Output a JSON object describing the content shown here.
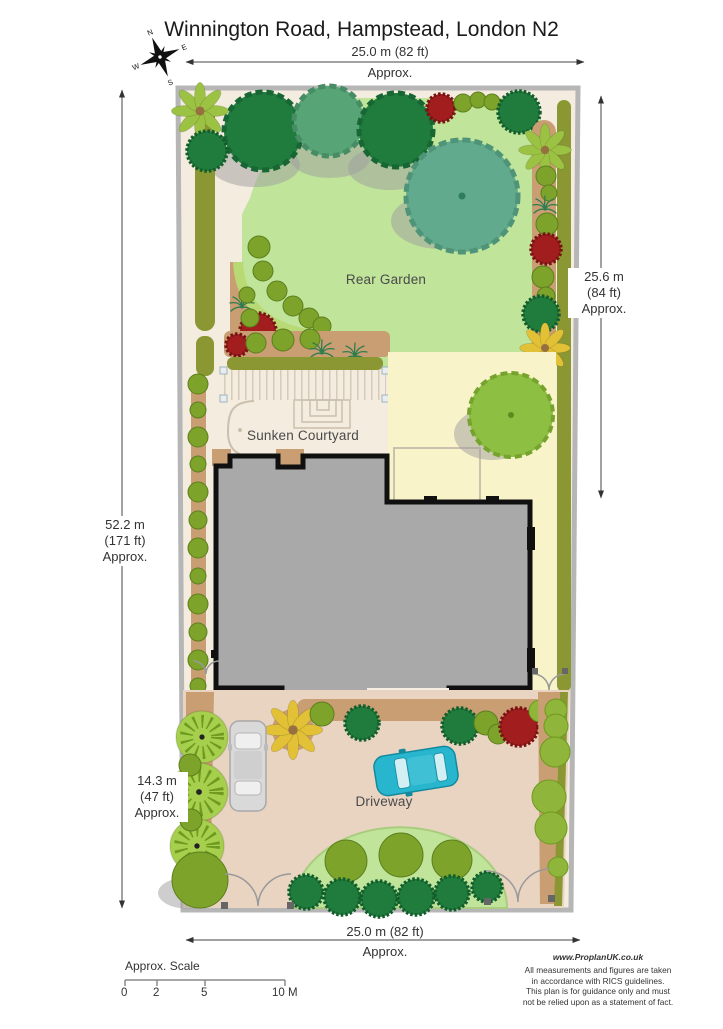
{
  "title": "Winnington Road, Hampstead, London N2",
  "compass": {
    "n": "N",
    "e": "E",
    "s": "S",
    "w": "W"
  },
  "dimensions": {
    "top": {
      "value": "25.0 m (82 ft)",
      "approx": "Approx."
    },
    "bottom": {
      "value": "25.0 m (82 ft)",
      "approx": "Approx."
    },
    "right": {
      "l1": "25.6 m",
      "l2": "(84 ft)",
      "l3": "Approx."
    },
    "left": {
      "l1": "52.2 m",
      "l2": "(171 ft)",
      "l3": "Approx."
    },
    "front": {
      "l1": "14.3 m",
      "l2": "(47 ft)",
      "l3": "Approx."
    }
  },
  "areas": {
    "rear_garden": "Rear Garden",
    "sunken_courtyard": "Sunken Courtyard",
    "driveway": "Driveway"
  },
  "scale_bar": {
    "label": "Approx. Scale",
    "ticks": [
      "0",
      "2",
      "5",
      "10 M"
    ]
  },
  "footer": {
    "website": "www.ProplanUK.co.uk",
    "lines": [
      "All measurements and figures are taken",
      "in accordance with RICS guidelines.",
      "This plan is for guidance only and must",
      "not be relied upon as a statement of fact."
    ]
  },
  "colors": {
    "cream": "#f4ecdf",
    "lawn": "#bfe49a",
    "patio": "#f9f3c9",
    "driveway": "#e9d4c2",
    "building": "#a9a9a9",
    "outline": "#101010",
    "wall": "#b6b6b6",
    "hedge": "#8a9733",
    "soil": "#c89e72",
    "tree_dark": "#1f7c3d",
    "tree_teal": "#61aa8d",
    "tree_mid": "#57a477",
    "tree_apple": "#8dbf42",
    "tree_fan": "#a6cf4d",
    "bush_olive": "#7da32b",
    "bush_red": "#a21d1d",
    "plant_yellow": "#e2c136",
    "car_cyan": "#28b6ce",
    "car_silver": "#d9d9d9",
    "shadow": "#9d9d9d"
  }
}
